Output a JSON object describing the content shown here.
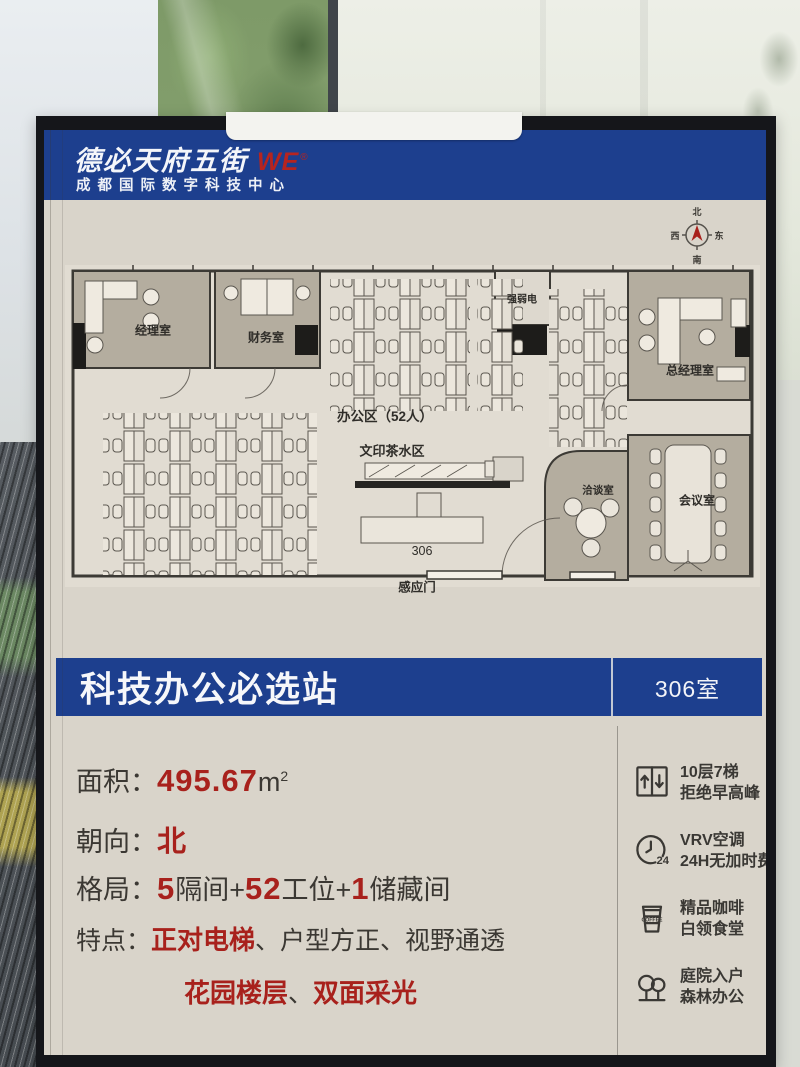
{
  "header": {
    "brand": "德必天府五街",
    "brand_mark": "WE",
    "brand_reg": "®",
    "subtitle": "成都国际数字科技中心"
  },
  "compass": {
    "n": "北",
    "e": "东",
    "s": "南",
    "w": "西"
  },
  "plan": {
    "room_manager": "经理室",
    "room_finance": "财务室",
    "room_electrical": "强弱电",
    "room_gm": "总经理室",
    "room_meeting": "会议室",
    "room_negotiation": "洽谈室",
    "label_office_area": "办公区（52人）",
    "label_print_tea": "文印茶水区",
    "label_room_number": "306",
    "label_sensor_door": "感应门"
  },
  "banner": {
    "title": "科技办公必选站",
    "room": "306室"
  },
  "specs": {
    "area_label": "面积：",
    "area_value": "495.67",
    "area_unit": "m",
    "area_sup": "2",
    "facing_label": "朝向：",
    "facing_value": "北",
    "layout_label": "格局：",
    "layout_n1": "5",
    "layout_t1": "隔间+",
    "layout_n2": "52",
    "layout_t2": "工位+",
    "layout_n3": "1",
    "layout_t3": "储藏间",
    "features_label": "特点：",
    "feat_red1": "正对电梯",
    "feat_dark1": "、户型方正、视野通透",
    "feat_red2": "花园楼层",
    "feat_sep": "、",
    "feat_red3": "双面采光"
  },
  "amenities": [
    {
      "icon": "elevator-icon",
      "line1": "10层7梯",
      "line2": "拒绝早高峰"
    },
    {
      "icon": "clock-24-icon",
      "line1": "VRV空调",
      "line2": "24H无加时费",
      "badge": "24"
    },
    {
      "icon": "coffee-icon",
      "line1": "精品咖啡",
      "line2": "白领食堂",
      "badge": "COFFEE"
    },
    {
      "icon": "trees-icon",
      "line1": "庭院入户",
      "line2": "森林办公"
    }
  ],
  "colors": {
    "banner_blue": "#1d3f8e",
    "accent_red": "#a8211c",
    "ink": "#3b3833"
  }
}
